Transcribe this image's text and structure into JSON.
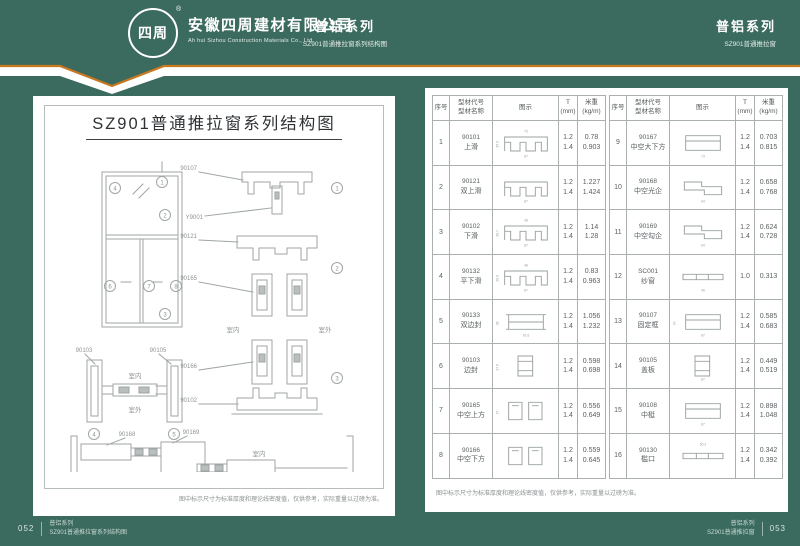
{
  "colors": {
    "green": "#3b6a5e",
    "orange": "#c8791f",
    "page": "#ffffff",
    "line": "#a0a6a6",
    "text": "#5a5f60"
  },
  "header": {
    "logo_mark": "四周",
    "registered": "®",
    "company_cn": "安徽四周建材有限公司",
    "company_en": "Ah hui Sizhou Construction Materials Co., Ltd.",
    "series_center": {
      "title": "普铝系列",
      "subtitle": "SZ901普通推拉窗系列结构图"
    },
    "series_right": {
      "title": "普铝系列",
      "subtitle": "SZ901普通推拉窗"
    }
  },
  "left_page": {
    "title": "SZ901普通推拉窗系列结构图",
    "note": "图中标示尺寸为标准厚度和理论线密度值，仅供参考，实际重量以过磅为准。",
    "elevation": {
      "c1": "1",
      "c2": "2",
      "c3": "3",
      "c4": "4",
      "c6": "6",
      "c7": "7",
      "c8": "8"
    },
    "vs": {
      "labels": [
        "90107",
        "Y9001",
        "90121",
        "90165",
        "90166",
        "90102"
      ],
      "c1": "1",
      "c2": "2",
      "c3": "3",
      "indoor": "室内",
      "outdoor": "室外"
    },
    "hs_top": {
      "labels": [
        "90103",
        "90105"
      ],
      "c4": "4",
      "c5": "5",
      "indoor": "室内",
      "outdoor": "室外"
    },
    "hs_bottom": {
      "labels": [
        "90168",
        "90169"
      ],
      "c6": "6",
      "c7": "7",
      "c8": "8",
      "indoor": "室内",
      "outdoor": "室外"
    }
  },
  "right_page": {
    "note": "图中标示尺寸为标准厚度和理论线密度值，仅供参考，实际重量以过磅为准。",
    "table": {
      "headers": {
        "seq": "序号",
        "code1": "型材代号",
        "code2": "型材名称",
        "diagram": "图示",
        "t1": "T",
        "t2": "(mm)",
        "w1": "米重",
        "w2": "(kg/m)"
      },
      "rows": [
        {
          "seq": "1",
          "code": "90101",
          "name": "上滑",
          "shape": "comb",
          "t": [
            "1.2",
            "1.4"
          ],
          "w": [
            "0.78",
            "0.903"
          ],
          "dims": {
            "t": "73",
            "b": "87",
            "l": "35.5"
          }
        },
        {
          "seq": "2",
          "code": "90121",
          "name": "双上滑",
          "shape": "comb",
          "t": [
            "1.2",
            "1.4"
          ],
          "w": [
            "1.227",
            "1.424"
          ],
          "dims": {
            "b": "87"
          }
        },
        {
          "seq": "3",
          "code": "90102",
          "name": "下滑",
          "shape": "comb",
          "t": [
            "1.2",
            "1.4"
          ],
          "w": [
            "1.14",
            "1.28"
          ],
          "dims": {
            "t": "48",
            "b": "87",
            "l": "36.7"
          }
        },
        {
          "seq": "4",
          "code": "90132",
          "name": "平下滑",
          "shape": "comb",
          "t": [
            "1.2",
            "1.4"
          ],
          "w": [
            "0.83",
            "0.963"
          ],
          "dims": {
            "t": "48",
            "b": "87",
            "l": "26.5"
          }
        },
        {
          "seq": "5",
          "code": "90133",
          "name": "双边封",
          "shape": "ibeam",
          "t": [
            "1.2",
            "1.4"
          ],
          "w": [
            "1.056",
            "1.232"
          ],
          "dims": {
            "b": "91.6",
            "l": "36"
          }
        },
        {
          "seq": "6",
          "code": "90103",
          "name": "边封",
          "shape": "tallbox",
          "t": [
            "1.2",
            "1.4"
          ],
          "w": [
            "0.598",
            "0.698"
          ],
          "dims": {
            "l": "37.5"
          }
        },
        {
          "seq": "7",
          "code": "90165",
          "name": "中空上方",
          "shape": "pair",
          "t": [
            "1.2",
            "1.4"
          ],
          "w": [
            "0.556",
            "0.649"
          ],
          "dims": {
            "l": "27"
          }
        },
        {
          "seq": "8",
          "code": "90166",
          "name": "中空下方",
          "shape": "pair",
          "t": [
            "1.2",
            "1.4"
          ],
          "w": [
            "0.559",
            "0.645"
          ],
          "dims": {}
        },
        {
          "seq": "9",
          "code": "90167",
          "name": "中空大下方",
          "shape": "box",
          "t": [
            "1.2",
            "1.4"
          ],
          "w": [
            "0.703",
            "0.815"
          ],
          "dims": {
            "b": "73"
          }
        },
        {
          "seq": "10",
          "code": "90168",
          "name": "中空光企",
          "shape": "zbox",
          "t": [
            "1.2",
            "1.4"
          ],
          "w": [
            "0.658",
            "0.768"
          ],
          "dims": {
            "b": "64"
          }
        },
        {
          "seq": "11",
          "code": "90169",
          "name": "中空勾企",
          "shape": "zbox",
          "t": [
            "1.2",
            "1.4"
          ],
          "w": [
            "0.624",
            "0.728"
          ],
          "dims": {
            "b": "64"
          }
        },
        {
          "seq": "12",
          "code": "SC001",
          "name": "纱窗",
          "shape": "flat",
          "t": [
            "1.0"
          ],
          "w": [
            "0.313"
          ],
          "dims": {
            "b": "46"
          }
        },
        {
          "seq": "13",
          "code": "90107",
          "name": "固定框",
          "shape": "box",
          "t": [
            "1.2",
            "1.4"
          ],
          "w": [
            "0.585",
            "0.683"
          ],
          "dims": {
            "b": "87",
            "l": "30"
          }
        },
        {
          "seq": "14",
          "code": "90105",
          "name": "盖板",
          "shape": "tallbox",
          "t": [
            "1.2",
            "1.4"
          ],
          "w": [
            "0.449",
            "0.519"
          ],
          "dims": {
            "b": "87"
          }
        },
        {
          "seq": "15",
          "code": "90108",
          "name": "中梃",
          "shape": "box",
          "t": [
            "1.2",
            "1.4"
          ],
          "w": [
            "0.898",
            "1.048"
          ],
          "dims": {
            "b": "87"
          }
        },
        {
          "seq": "16",
          "code": "90130",
          "name": "槛口",
          "shape": "flat",
          "t": [
            "1.2",
            "1.4"
          ],
          "w": [
            "0.342",
            "0.392"
          ],
          "dims": {
            "t": "50.2"
          }
        }
      ]
    }
  },
  "footer": {
    "left": {
      "page": "052",
      "line1": "普铝系列",
      "line2": "SZ901普通推拉窗系列结构图"
    },
    "right": {
      "page": "053",
      "line1": "普铝系列",
      "line2": "SZ901普通推拉窗"
    }
  }
}
